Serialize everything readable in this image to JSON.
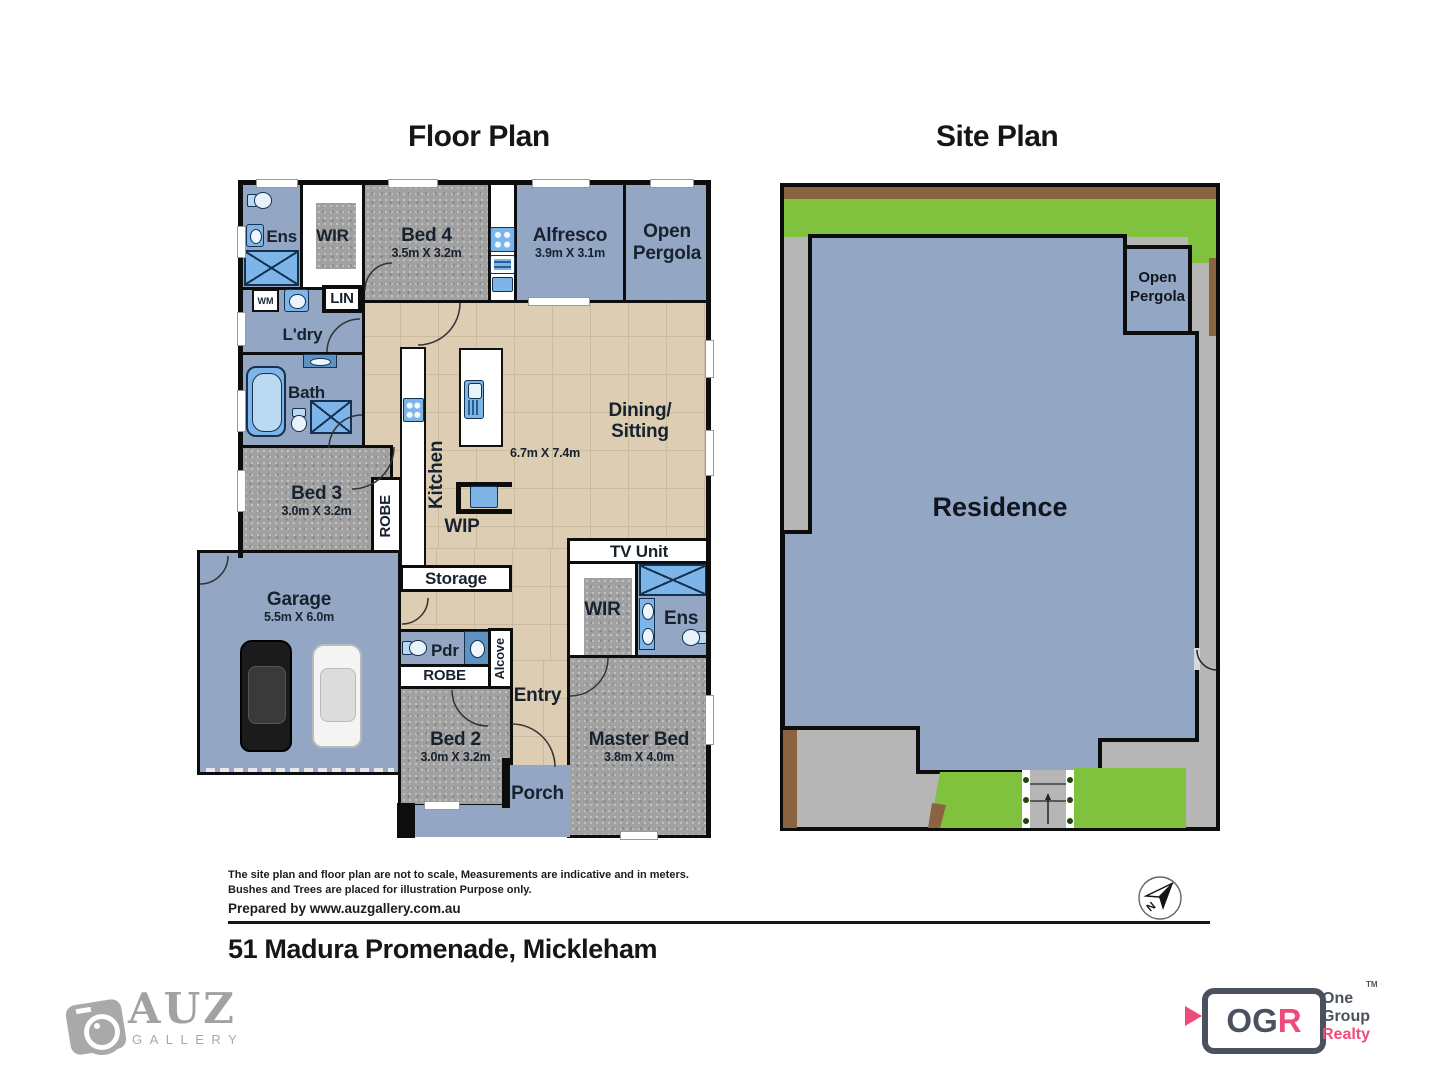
{
  "floor_plan": {
    "title": "Floor Plan",
    "rooms": {
      "ens1": "Ens",
      "wir1": "WIR",
      "bed4": {
        "name": "Bed 4",
        "dims": "3.5m X 3.2m"
      },
      "alfresco": {
        "name": "Alfresco",
        "dims": "3.9m X 3.1m"
      },
      "pergola": {
        "line1": "Open",
        "line2": "Pergola"
      },
      "wm": "WM",
      "lin": "LIN",
      "ldry": "L'dry",
      "bath": "Bath",
      "bed3": {
        "name": "Bed 3",
        "dims": "3.0m X 3.2m"
      },
      "robe1": "ROBE",
      "kitchen": "Kitchen",
      "dining": {
        "line1": "Dining/",
        "line2": "Sitting",
        "dims": "6.7m X 7.4m"
      },
      "wip": "WIP",
      "storage": "Storage",
      "tv_unit": "TV Unit",
      "garage": {
        "name": "Garage",
        "dims": "5.5m X 6.0m"
      },
      "wir2": "WIR",
      "ens2": "Ens",
      "pdr": "Pdr",
      "alcove": "Alcove",
      "robe2": "ROBE",
      "bed2": {
        "name": "Bed 2",
        "dims": "3.0m X 3.2m"
      },
      "entry": "Entry",
      "master": {
        "name": "Master Bed",
        "dims": "3.8m X 4.0m"
      },
      "porch": "Porch"
    }
  },
  "site_plan": {
    "title": "Site Plan",
    "residence": "Residence",
    "pergola": {
      "line1": "Open",
      "line2": "Pergola"
    }
  },
  "footer": {
    "disclaimer1": "The site plan and floor plan are not to scale, Measurements are indicative and in meters.",
    "disclaimer2": "Bushes and Trees are placed for illustration Purpose only.",
    "prepared": "Prepared by www.auzgallery.com.au",
    "address": "51 Madura Promenade, Mickleham",
    "compass_n": "N"
  },
  "branding": {
    "auz": {
      "name": "AUZ",
      "sub": "GALLERY"
    },
    "ogr": {
      "og": "OG",
      "r": "R",
      "one": "One",
      "group": "Group",
      "realty": "Realty",
      "tm": "TM"
    }
  },
  "colors": {
    "plan_blue": "#93a7c5",
    "carpet_gray": "#a1a1a1",
    "tile_beige": "#ddcdb3",
    "wall_black": "#0d0d0d",
    "fixture_blue": "#7db5e8",
    "site_gray": "#b6b6b6",
    "grass_green": "#80c13d",
    "fence_brown": "#8a6340",
    "ogr_slate": "#4a5260",
    "ogr_pink": "#ee4b7a",
    "auz_gray": "#a2a2a2"
  }
}
